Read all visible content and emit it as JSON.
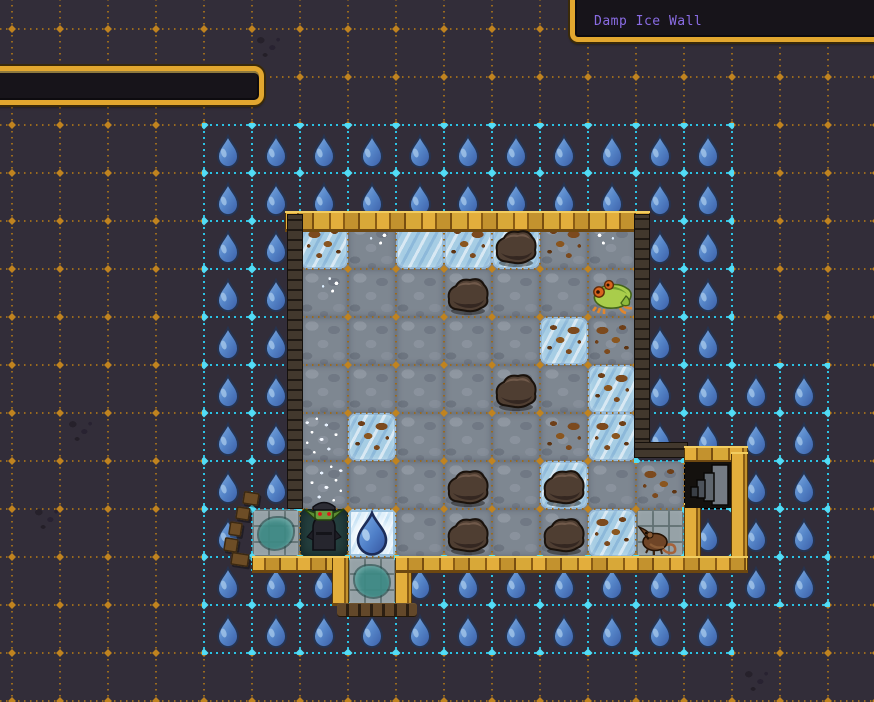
{
  "tooltip": {
    "text": "Damp Ice Wall"
  },
  "info_panel": {
    "text": ""
  },
  "palette": {
    "background": "#322d39",
    "grid_orange": "#9a6a1e",
    "grid_orange_node": "#c0831f",
    "grid_cyan": "#2cc3e4",
    "grid_cyan_node": "#52dcf6",
    "droplet_blue": "#5585c8",
    "gold_wall": "#d8a838",
    "dark_wall": "#362d24",
    "panel_border_gold": "#e2a72f",
    "tooltip_text_purple": "#8a6ce4",
    "ice": "#a6cde4",
    "cobble": "#7e8791"
  },
  "grid": {
    "cell_size": 48,
    "origin_x": 12,
    "origin_y": 29
  },
  "damp_cells": {
    "rows": [
      {
        "row": 2,
        "cols": [
          4,
          5,
          6,
          7,
          8,
          9,
          10,
          11,
          12,
          13,
          14
        ]
      },
      {
        "row": 3,
        "cols": [
          4,
          5,
          6,
          7,
          8,
          9,
          10,
          11,
          12,
          13,
          14
        ]
      },
      {
        "row": 4,
        "cols": [
          4,
          5,
          13,
          14
        ]
      },
      {
        "row": 5,
        "cols": [
          4,
          5,
          13,
          14
        ]
      },
      {
        "row": 6,
        "cols": [
          4,
          5,
          13,
          14
        ]
      },
      {
        "row": 7,
        "cols": [
          4,
          5,
          13,
          14,
          15,
          16
        ]
      },
      {
        "row": 8,
        "cols": [
          4,
          5,
          13,
          14,
          15,
          16
        ]
      },
      {
        "row": 9,
        "cols": [
          4,
          5,
          15,
          16
        ]
      },
      {
        "row": 10,
        "cols": [
          4,
          14,
          15,
          16
        ]
      },
      {
        "row": 11,
        "cols": [
          4,
          5,
          6,
          8,
          9,
          10,
          11,
          12,
          13,
          14,
          15,
          16
        ]
      },
      {
        "row": 12,
        "cols": [
          4,
          5,
          6,
          7,
          8,
          9,
          10,
          11,
          12,
          13,
          14
        ]
      }
    ]
  },
  "room": {
    "col": 6,
    "row": 4,
    "cols": 7,
    "rows": 7,
    "tiles": [
      [
        "ice dirt",
        "cobble sparkle",
        "ice",
        "ice dirt",
        "ice",
        "cobble dirt",
        "cobble sparkle"
      ],
      [
        "cobble sparkle",
        "cobble",
        "cobble",
        "cobble",
        "cobble",
        "cobble",
        "cobble"
      ],
      [
        "cobble",
        "cobble",
        "cobble",
        "cobble",
        "cobble",
        "ice dirt",
        "cobble dirt"
      ],
      [
        "cobble",
        "cobble",
        "cobble",
        "cobble",
        "cobble",
        "cobble",
        "ice dirt"
      ],
      [
        "cobble speckle",
        "ice dirt",
        "cobble",
        "cobble",
        "cobble",
        "cobble dirt",
        "ice dirt"
      ],
      [
        "cobble speckle",
        "cobble",
        "cobble",
        "cobble",
        "cobble",
        "ice",
        "cobble"
      ],
      [
        "darkfloor",
        "icebright",
        "cobble",
        "cobble",
        "cobble",
        "cobble",
        "ice dirt"
      ]
    ],
    "extra_tiles": [
      {
        "col": 13,
        "row": 9,
        "type": "cobble dirt",
        "name": "floor-tile-cobble"
      },
      {
        "col": 14,
        "row": 9,
        "type": "stairsfloor",
        "name": "stairs-tile"
      },
      {
        "col": 13,
        "row": 10,
        "type": "stone",
        "name": "rat-tile"
      },
      {
        "col": 5,
        "row": 10,
        "type": "stone teal",
        "name": "alcove-tile-left"
      },
      {
        "col": 7,
        "row": 11,
        "type": "stone teal",
        "name": "alcove-tile-bottom"
      }
    ]
  },
  "walls": [
    {
      "kind": "gold",
      "x": 285,
      "y": 211,
      "w": 365,
      "h": 21,
      "name": "room-wall-top"
    },
    {
      "kind": "dark",
      "x": 287,
      "y": 214,
      "w": 16,
      "h": 295,
      "name": "room-wall-left"
    },
    {
      "kind": "dark",
      "x": 634,
      "y": 214,
      "w": 16,
      "h": 234,
      "name": "room-wall-right"
    },
    {
      "kind": "dark",
      "x": 634,
      "y": 442,
      "w": 54,
      "h": 16,
      "name": "wall-extension-top"
    },
    {
      "kind": "gold",
      "x": 684,
      "y": 446,
      "w": 64,
      "h": 17,
      "name": "stairs-wall-top"
    },
    {
      "kind": "gold",
      "x": 731,
      "y": 452,
      "w": 17,
      "h": 120,
      "name": "stairs-wall-right"
    },
    {
      "kind": "gold",
      "x": 684,
      "y": 503,
      "w": 17,
      "h": 58,
      "name": "rat-wall-right"
    },
    {
      "kind": "gold",
      "x": 252,
      "y": 556,
      "w": 96,
      "h": 17,
      "name": "room-wall-bottom-left"
    },
    {
      "kind": "gold",
      "x": 332,
      "y": 556,
      "w": 17,
      "h": 50,
      "name": "alcove-wall-left"
    },
    {
      "kind": "gold",
      "x": 395,
      "y": 556,
      "w": 17,
      "h": 50,
      "name": "alcove-wall-right"
    },
    {
      "kind": "gold",
      "x": 395,
      "y": 556,
      "w": 353,
      "h": 17,
      "name": "room-wall-bottom-right"
    },
    {
      "kind": "ruin",
      "x": 337,
      "y": 603,
      "w": 80,
      "h": 14,
      "name": "alcove-wall-ruined"
    }
  ],
  "rubble": [
    {
      "x": 243,
      "y": 492,
      "w": 16,
      "h": 13
    },
    {
      "x": 236,
      "y": 507,
      "w": 14,
      "h": 13
    },
    {
      "x": 229,
      "y": 522,
      "w": 13,
      "h": 14
    },
    {
      "x": 224,
      "y": 538,
      "w": 14,
      "h": 14
    },
    {
      "x": 231,
      "y": 553,
      "w": 18,
      "h": 13
    }
  ],
  "entities": [
    {
      "type": "boulder",
      "col": 10,
      "row": 4
    },
    {
      "type": "boulder",
      "col": 9,
      "row": 5
    },
    {
      "type": "frog",
      "col": 12,
      "row": 5
    },
    {
      "type": "boulder",
      "col": 10,
      "row": 7
    },
    {
      "type": "boulder",
      "col": 9,
      "row": 9
    },
    {
      "type": "boulder",
      "col": 11,
      "row": 9
    },
    {
      "type": "boulder",
      "col": 9,
      "row": 10
    },
    {
      "type": "boulder",
      "col": 11,
      "row": 10
    },
    {
      "type": "goblin",
      "col": 6,
      "row": 10
    },
    {
      "type": "water-drop",
      "col": 7,
      "row": 10
    },
    {
      "type": "rat",
      "col": 13,
      "row": 10
    },
    {
      "type": "stairs",
      "col": 14,
      "row": 9
    }
  ],
  "smudges": [
    {
      "x": 250,
      "y": 30
    },
    {
      "x": 742,
      "y": 16
    },
    {
      "x": 28,
      "y": 502
    },
    {
      "x": 738,
      "y": 664
    },
    {
      "x": 62,
      "y": 414
    }
  ]
}
